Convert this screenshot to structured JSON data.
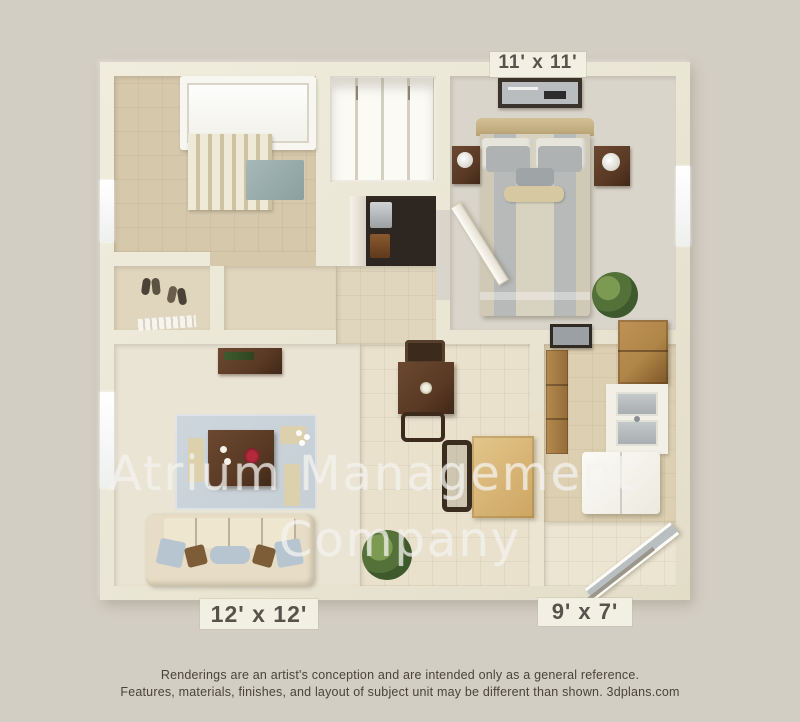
{
  "image": {
    "type": "3d-floor-plan-rendering",
    "watermark": {
      "line1": "Atrium Management",
      "line2": "Company"
    },
    "room_labels": {
      "bedroom": "11' x 11'",
      "living_room": "12' x 12'",
      "kitchen": "9' x 7'"
    },
    "disclaimer": {
      "line1": "Renderings are an artist's conception and are intended only as a general reference.",
      "line2": "Features, materials, finishes, and layout of subject unit may be different than shown. 3dplans.com"
    },
    "colors": {
      "background": "#d3cec3",
      "wall": "#ebe7d6",
      "wall_shadow": "#c9c2ab",
      "bath_tile": "#d6c8ab",
      "bedroom_carpet": "#d9d5ca",
      "living_carpet": "#eae4d4",
      "tile_floor": "#e9e1cc",
      "kitchen_floor": "#ddd0b2",
      "entry_tile": "#ece5d2",
      "hall_floor": "#e0d6bd",
      "wood_dark": "#5a3a25",
      "wood_mid": "#b08548",
      "rug": "#c6cfd6",
      "sofa": "#e7ddc6",
      "label_bg": "#f2efe3",
      "label_text": "#57534b",
      "watermark": "rgba(242,241,237,0.62)",
      "disclaimer_text": "#48443a"
    }
  }
}
